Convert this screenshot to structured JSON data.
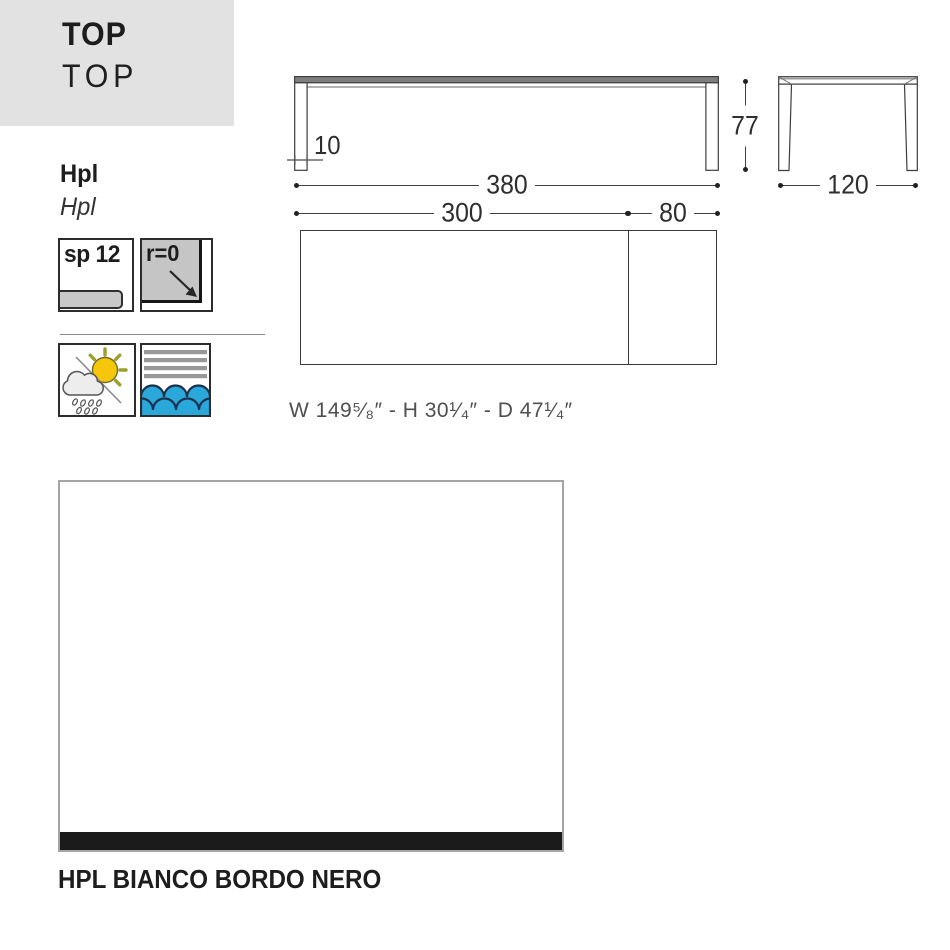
{
  "header": {
    "title": "TOP",
    "subtitle": "TOP"
  },
  "material": {
    "name": "Hpl",
    "name_alt": "Hpl"
  },
  "spec_icons": {
    "thickness": {
      "label": "sp 12"
    },
    "radius": {
      "label": "r=0"
    },
    "weather": {
      "meaning": "outdoor-weather-resistant"
    },
    "water": {
      "meaning": "water-resistant"
    }
  },
  "dimensions": {
    "total_length": "380",
    "main_length": "300",
    "extension_length": "80",
    "height": "77",
    "depth": "120",
    "top_thickness": "10",
    "imperial": "W 149⁵⁄₈″ - H 30¹⁄₄″  - D 47¹⁄₄″"
  },
  "finish": {
    "label": "HPL BIANCO BORDO NERO"
  },
  "colors": {
    "header_gray": "#e2e2e2",
    "panel_gray": "#c6c6c6",
    "sun_yellow": "#f6c60b",
    "water_blue": "#2aa8da",
    "stripe_gray": "#989898",
    "edge_black": "#1b1b1b"
  }
}
